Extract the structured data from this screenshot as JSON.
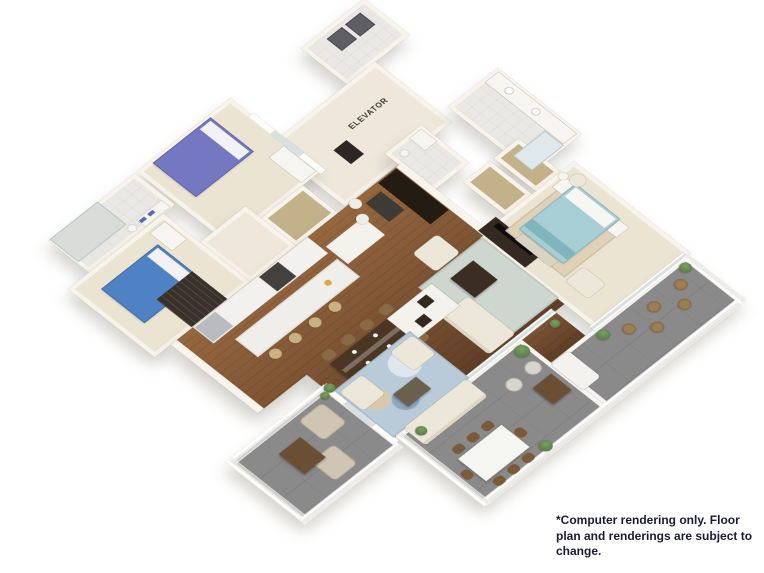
{
  "page": {
    "background": "#ffffff",
    "width": 764,
    "height": 573
  },
  "floorplan": {
    "elevator_label": "ELEVATOR",
    "colors": {
      "wall": "#f8f4ec",
      "wall_shade": "#ddd6c6",
      "carpet": "#ebe4d3",
      "tile": "#e9e8e4",
      "hall": "#efe8da",
      "closet_tan": "#c2b189",
      "wood": "#7d5434",
      "wood_light": "#96673f",
      "wood_dark": "#5f3e27",
      "terrace": "#8a8a8a",
      "terrace_dark": "#747474",
      "railing": "#f7f6f2",
      "bed_purple": "#7478c0",
      "bed_teal": "#a7ced4",
      "bed_blue": "#4f82c4",
      "rug_blue": "#b9cbd9",
      "rug_living": "#cdd6cf",
      "dark_wood": "#32281e",
      "cabinet": "#f2f1ed",
      "marble": "#efeeea",
      "stool_tan": "#c8b183",
      "plant": "#5c7c49",
      "appliance_gray": "#5f5f63"
    }
  },
  "disclaimer": {
    "text": "*Computer rendering only. Floor plan and renderings are subject to change.",
    "color": "#1b1b35"
  }
}
